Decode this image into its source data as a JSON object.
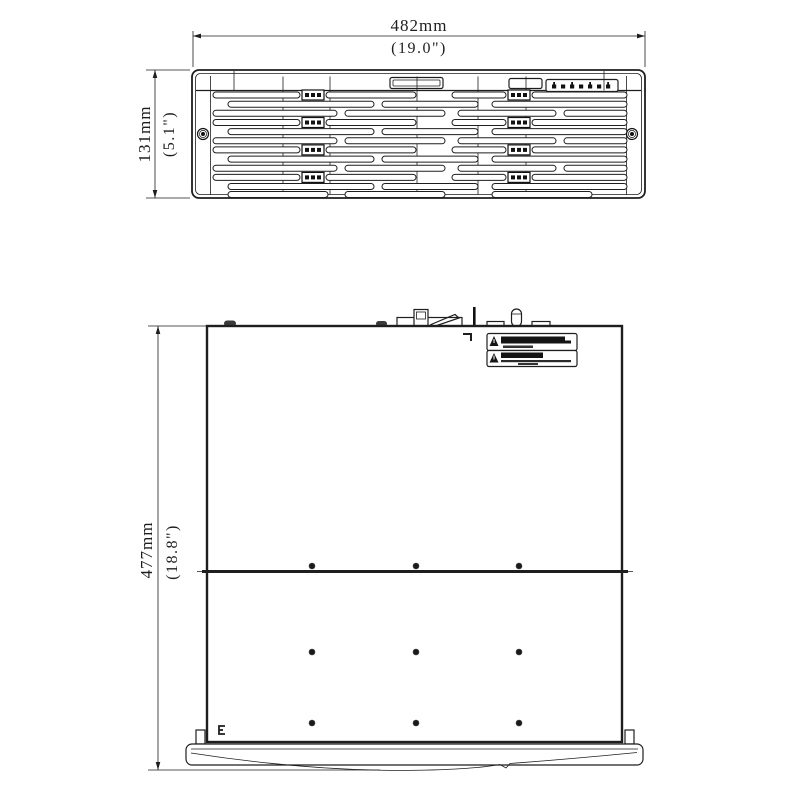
{
  "drawing": {
    "title": "rack-chassis-dimension-drawing",
    "front_view": {
      "name": "front-panel-view",
      "width_dim_mm": "482mm",
      "width_dim_inch": "(19.0\")",
      "height_dim_mm": "131mm",
      "height_dim_inch": "(5.1\")",
      "drive_rows": 4,
      "led_indicators": {
        "name": "status-led-icons",
        "count": 7
      }
    },
    "top_view": {
      "name": "top-view",
      "depth_dim_mm": "477mm",
      "depth_dim_inch": "(18.8\")",
      "warning_label": {
        "rows": 2,
        "icon": "warning-triangle-icon"
      },
      "screw_dot_grid": {
        "columns": 3,
        "rows": 3
      }
    }
  },
  "geometry": {
    "front": {
      "box": [
        192,
        70,
        453,
        128
      ],
      "slat_h": 6,
      "lines": [
        {
          "y": 92.0,
          "latch": true,
          "segs": [
            [
              213,
              87
            ],
            [
              326,
              90
            ],
            [
              452,
              54
            ],
            [
              532,
              95
            ]
          ]
        },
        {
          "y": 101.2,
          "latch": false,
          "segs": [
            [
              228,
              146
            ],
            [
              382,
              96
            ],
            [
              492,
              135
            ]
          ]
        },
        {
          "y": 110.3,
          "latch": false,
          "segs": [
            [
              213,
              124
            ],
            [
              345,
              100
            ],
            [
              458,
              98
            ],
            [
              564,
              63
            ]
          ]
        },
        {
          "y": 119.5,
          "latch": true,
          "segs": [
            [
              213,
              87
            ],
            [
              326,
              90
            ],
            [
              452,
              54
            ],
            [
              532,
              95
            ]
          ]
        },
        {
          "y": 128.6,
          "latch": false,
          "segs": [
            [
              228,
              146
            ],
            [
              382,
              96
            ],
            [
              492,
              135
            ]
          ]
        },
        {
          "y": 137.8,
          "latch": false,
          "segs": [
            [
              213,
              124
            ],
            [
              345,
              100
            ],
            [
              458,
              98
            ],
            [
              564,
              63
            ]
          ]
        },
        {
          "y": 146.9,
          "latch": true,
          "segs": [
            [
              213,
              87
            ],
            [
              326,
              90
            ],
            [
              452,
              54
            ],
            [
              532,
              95
            ]
          ]
        },
        {
          "y": 156.1,
          "latch": false,
          "segs": [
            [
              228,
              146
            ],
            [
              382,
              96
            ],
            [
              492,
              135
            ]
          ]
        },
        {
          "y": 165.2,
          "latch": false,
          "segs": [
            [
              213,
              124
            ],
            [
              345,
              100
            ],
            [
              458,
              98
            ],
            [
              564,
              63
            ]
          ]
        },
        {
          "y": 174.4,
          "latch": true,
          "segs": [
            [
              213,
              87
            ],
            [
              326,
              90
            ],
            [
              452,
              54
            ],
            [
              532,
              95
            ]
          ]
        },
        {
          "y": 183.5,
          "latch": false,
          "segs": [
            [
              228,
              146
            ],
            [
              382,
              96
            ],
            [
              492,
              135
            ]
          ]
        },
        {
          "y": 191.5,
          "latch": false,
          "segs": [
            [
              228,
              100
            ],
            [
              345,
              100
            ],
            [
              492,
              100
            ]
          ]
        }
      ],
      "latch_x": [
        302,
        508
      ],
      "latch_w": 22,
      "dividers": [
        283,
        330,
        417,
        478,
        526
      ],
      "strip_ticks": [
        234,
        604
      ],
      "screws": [
        [
          203,
          134
        ],
        [
          632,
          134
        ]
      ],
      "led_xs": [
        552,
        561,
        570,
        579,
        588,
        597,
        606
      ]
    },
    "top": {
      "box": [
        207,
        326,
        415,
        416
      ],
      "mid_line_y": 571.5,
      "dot_xs": [
        312,
        416,
        519
      ],
      "dot_ys": [
        566,
        652,
        723
      ]
    }
  }
}
